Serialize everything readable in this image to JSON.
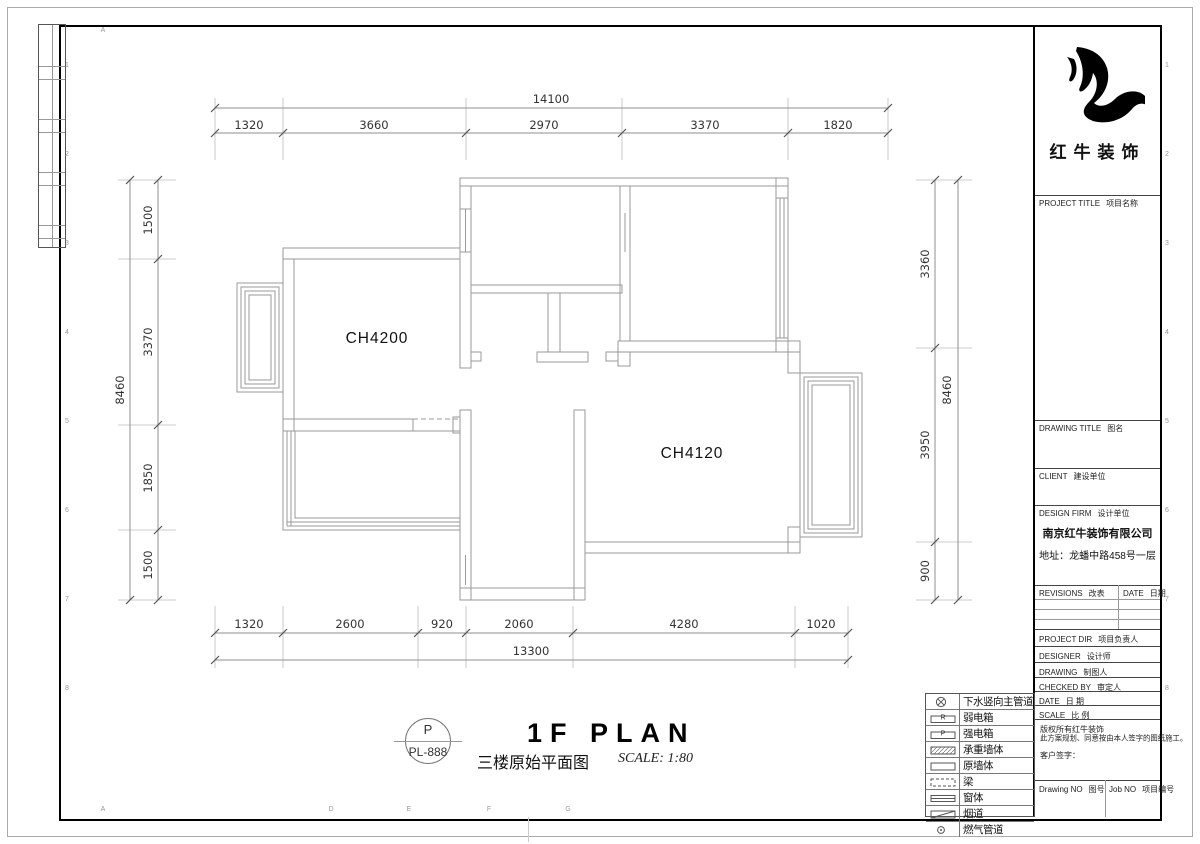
{
  "sheet": {
    "logo_text": "红牛装饰",
    "grid_bottom_letters": [
      "A",
      "D",
      "E",
      "F",
      "G"
    ],
    "grid_side_numbers": [
      "1",
      "2",
      "3",
      "4",
      "5",
      "6",
      "7",
      "8",
      "9"
    ]
  },
  "title_block": {
    "project_title_en": "PROJECT TITLE",
    "project_title_zh": "项目名称",
    "drawing_title_en": "DRAWING TITLE",
    "drawing_title_zh": "图名",
    "client_en": "CLIENT",
    "client_zh": "建设单位",
    "design_firm_en": "DESIGN FIRM",
    "design_firm_zh": "设计单位",
    "company": "南京红牛装饰有限公司",
    "address": "地址：龙蟠中路458号一层",
    "revisions_en": "REVISIONS",
    "revisions_zh": "改表",
    "date_col_en": "DATE",
    "date_col_zh": "日期",
    "rows": [
      {
        "en": "PROJECT DIR",
        "zh": "项目负责人"
      },
      {
        "en": "DESIGNER",
        "zh": "设计师"
      },
      {
        "en": "DRAWING",
        "zh": "制图人"
      },
      {
        "en": "CHECKED BY",
        "zh": "审定人"
      },
      {
        "en": "DATE",
        "zh": "日 期"
      },
      {
        "en": "SCALE",
        "zh": "比 例"
      }
    ],
    "notes": [
      "版权所有红牛装饰",
      "此方案规划、同意按由本人签字的图纸施工。",
      "客户签字："
    ],
    "drawing_no_en": "Drawing NO",
    "drawing_no_zh": "图号",
    "job_no_en": "Job NO",
    "job_no_zh": "项目编号"
  },
  "legend": {
    "items": [
      {
        "icon": "drain-pipe",
        "label": "下水竖向主管道"
      },
      {
        "icon": "weak-current-box",
        "letter": "R",
        "label": "弱电箱"
      },
      {
        "icon": "strong-current-box",
        "letter": "P",
        "label": "强电箱"
      },
      {
        "icon": "load-bearing-wall",
        "label": "承重墙体"
      },
      {
        "icon": "original-wall",
        "label": "原墙体"
      },
      {
        "icon": "beam",
        "label": "梁"
      },
      {
        "icon": "window",
        "label": "窗体"
      },
      {
        "icon": "flue",
        "label": "烟道"
      },
      {
        "icon": "gas-pipe",
        "label": "燃气管道"
      }
    ]
  },
  "titlebar": {
    "stamp_letter": "P",
    "stamp_code": "PL-888",
    "title": "1F PLAN",
    "subtitle": "三楼原始平面图",
    "scale": "SCALE: 1:80"
  },
  "plan": {
    "room_labels": [
      "CH4200",
      "CH4120"
    ]
  },
  "dimensions": {
    "top": {
      "total": "14100",
      "segments": [
        "1320",
        "3660",
        "2970",
        "3370",
        "1820"
      ]
    },
    "bottom": {
      "total": "13300",
      "segments": [
        "1320",
        "2600",
        "920",
        "2060",
        "4280",
        "1020"
      ]
    },
    "left": {
      "total": "8460",
      "segments": [
        "1500",
        "3370",
        "1850",
        "1500"
      ]
    },
    "right": {
      "total": "8460",
      "segments": [
        "3360",
        "3950",
        "900"
      ]
    }
  }
}
